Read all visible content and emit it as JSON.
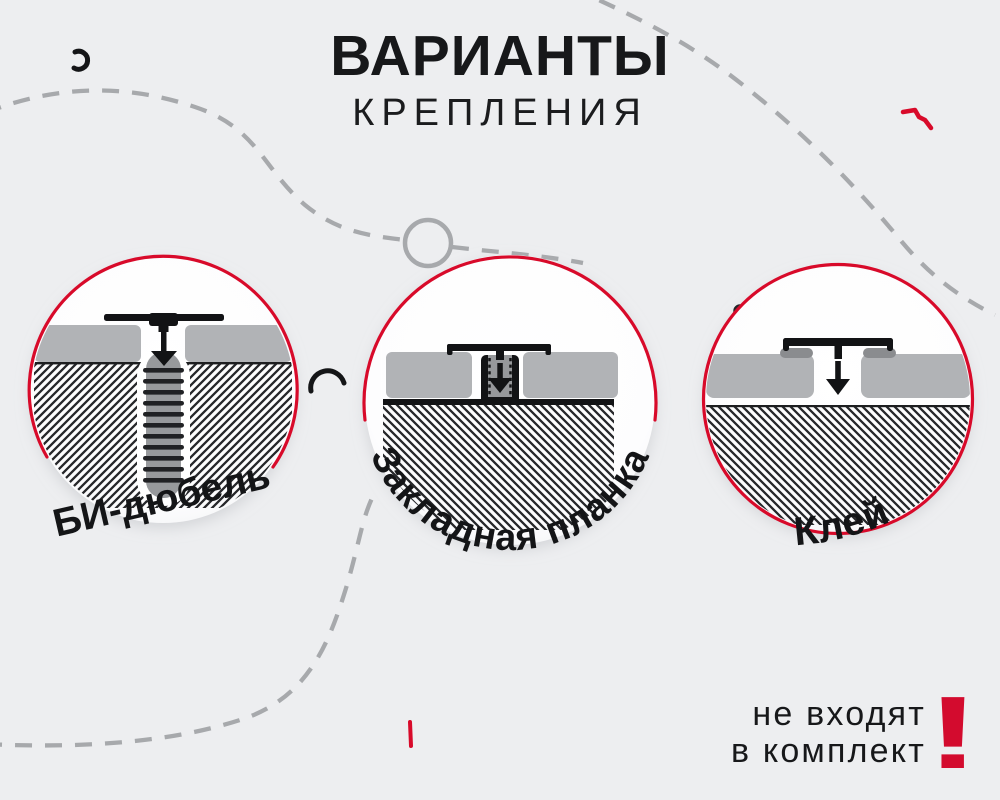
{
  "title": {
    "heading": "ВАРИАНТЫ",
    "subheading": "КРЕПЛЕНИЯ"
  },
  "options": [
    {
      "id": "bi-dowel",
      "label": "БИ-дюбель"
    },
    {
      "id": "embedded-plank",
      "label": "Закладная планка"
    },
    {
      "id": "glue",
      "label": "Клей"
    }
  ],
  "note": {
    "line1": "не входят",
    "line2": "в комплект",
    "mark": "!"
  },
  "colors": {
    "background": "#edeef0",
    "accent_red": "#d80a2a",
    "ink": "#17181a",
    "panel_gray": "#b1b3b6",
    "doodle_gray": "#a7a9ac",
    "hatch_line": "#26272a"
  }
}
